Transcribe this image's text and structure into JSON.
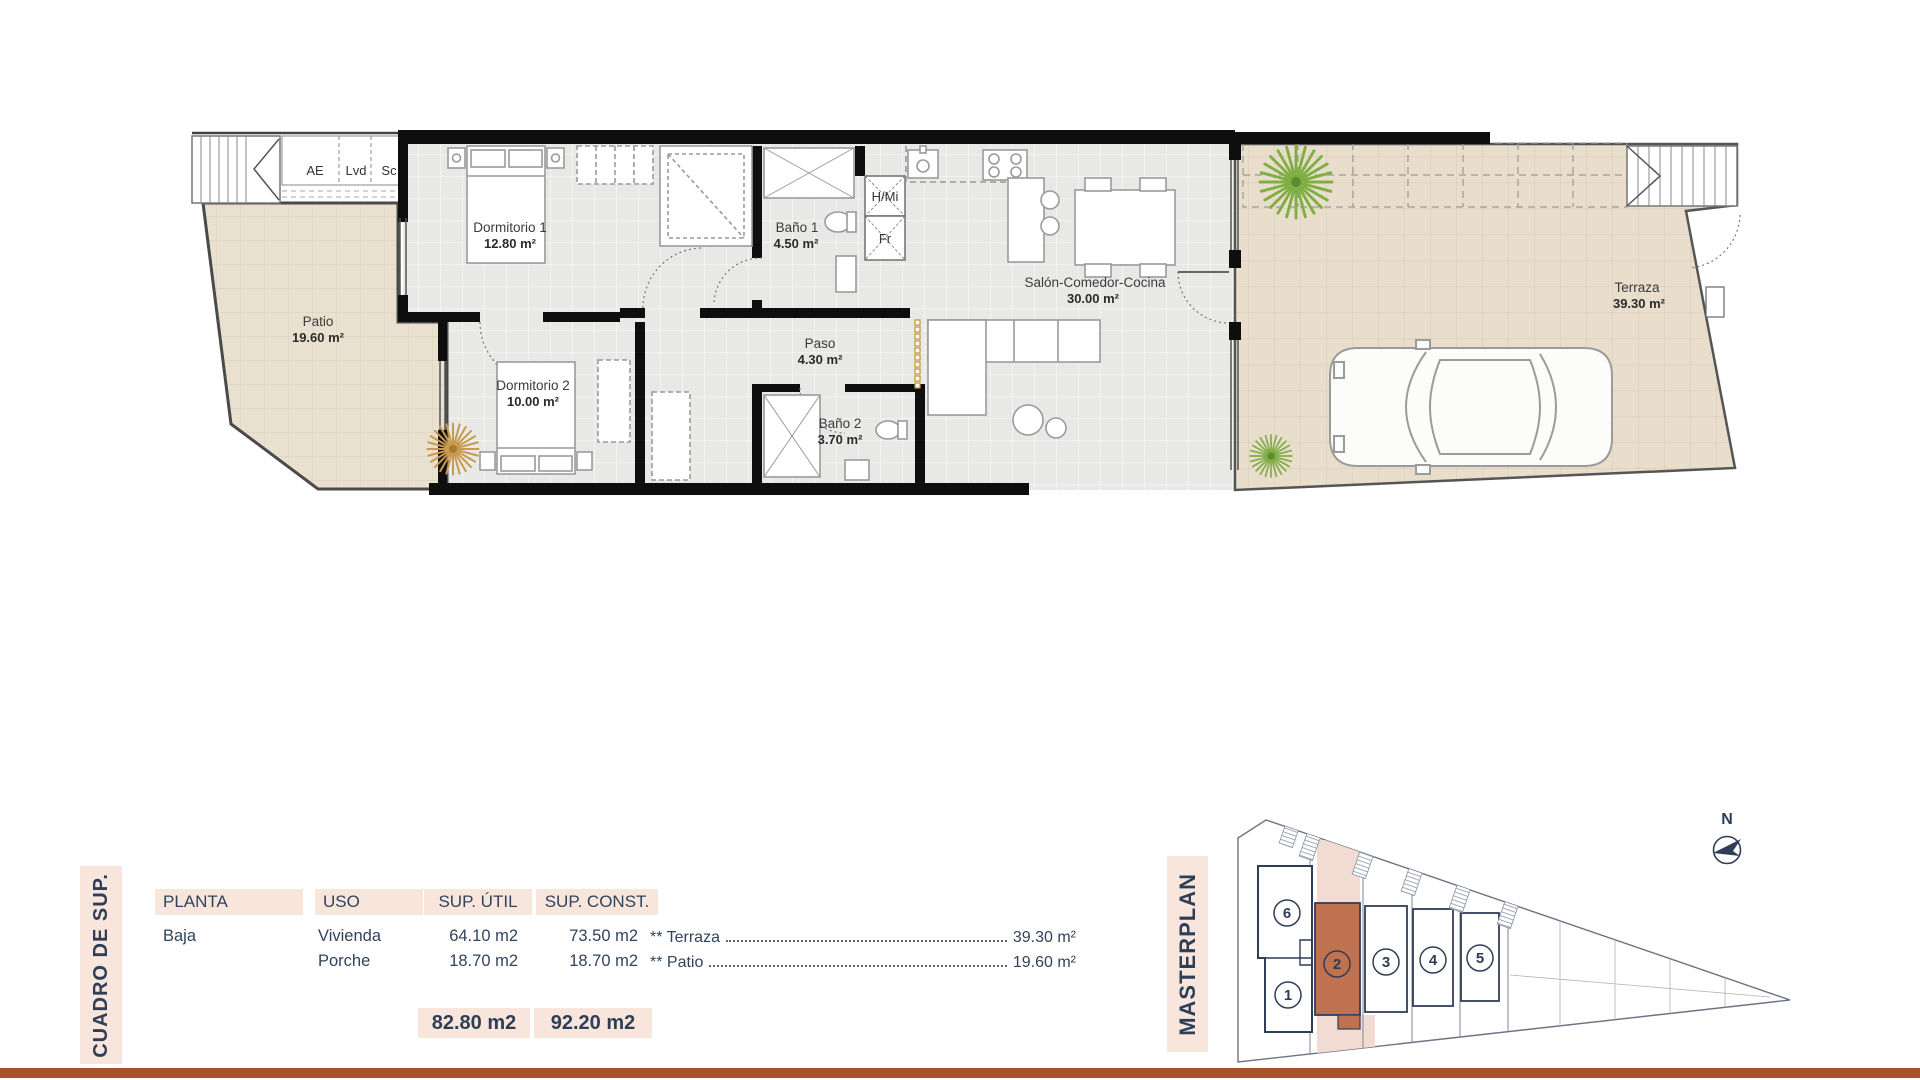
{
  "plan": {
    "rooms": [
      {
        "name": "Patio",
        "area": "19.60 m²"
      },
      {
        "name": "Dormitorio 1",
        "area": "12.80 m²"
      },
      {
        "name": "Baño 1",
        "area": "4.50 m²"
      },
      {
        "name": "Dormitorio 2",
        "area": "10.00 m²"
      },
      {
        "name": "Paso",
        "area": "4.30 m²"
      },
      {
        "name": "Baño 2",
        "area": "3.70 m²"
      },
      {
        "name": "Salón-Comedor-Cocina",
        "area": "30.00 m²"
      },
      {
        "name": "Terraza",
        "area": "39.30 m²"
      }
    ],
    "small_labels": {
      "ae": "AE",
      "lvd": "Lvd",
      "sc": "Sc",
      "hmi": "H/Mi",
      "fr": "Fr"
    }
  },
  "summary_table": {
    "side_label": "CUADRO DE SUP.",
    "headers": [
      "PLANTA",
      "USO",
      "SUP. ÚTIL",
      "SUP. CONST."
    ],
    "rows": [
      {
        "planta": "Baja",
        "uso": "Vivienda",
        "util": "64.10 m2",
        "const": "73.50 m2"
      },
      {
        "planta": "",
        "uso": "Porche",
        "util": "18.70 m2",
        "const": "18.70 m2"
      }
    ],
    "totals": {
      "util": "82.80 m2",
      "const": "92.20 m2"
    },
    "annotations": [
      {
        "label": "** Terraza",
        "value": "39.30 m²"
      },
      {
        "label": "** Patio",
        "value": "19.60 m²"
      }
    ]
  },
  "masterplan": {
    "side_label": "MASTERPLAN",
    "units": [
      "6",
      "1",
      "2",
      "3",
      "4",
      "5"
    ],
    "highlighted_unit": "2",
    "north_label": "N"
  },
  "colors": {
    "accent_terracotta": "#aa5030",
    "highlight_unit_fill": "#bf7150",
    "blush_panel": "#f8e5dc",
    "navy_text": "#2f3e57",
    "floor_gray": "#e8e8e7",
    "floor_beige": "#eae0d0"
  }
}
